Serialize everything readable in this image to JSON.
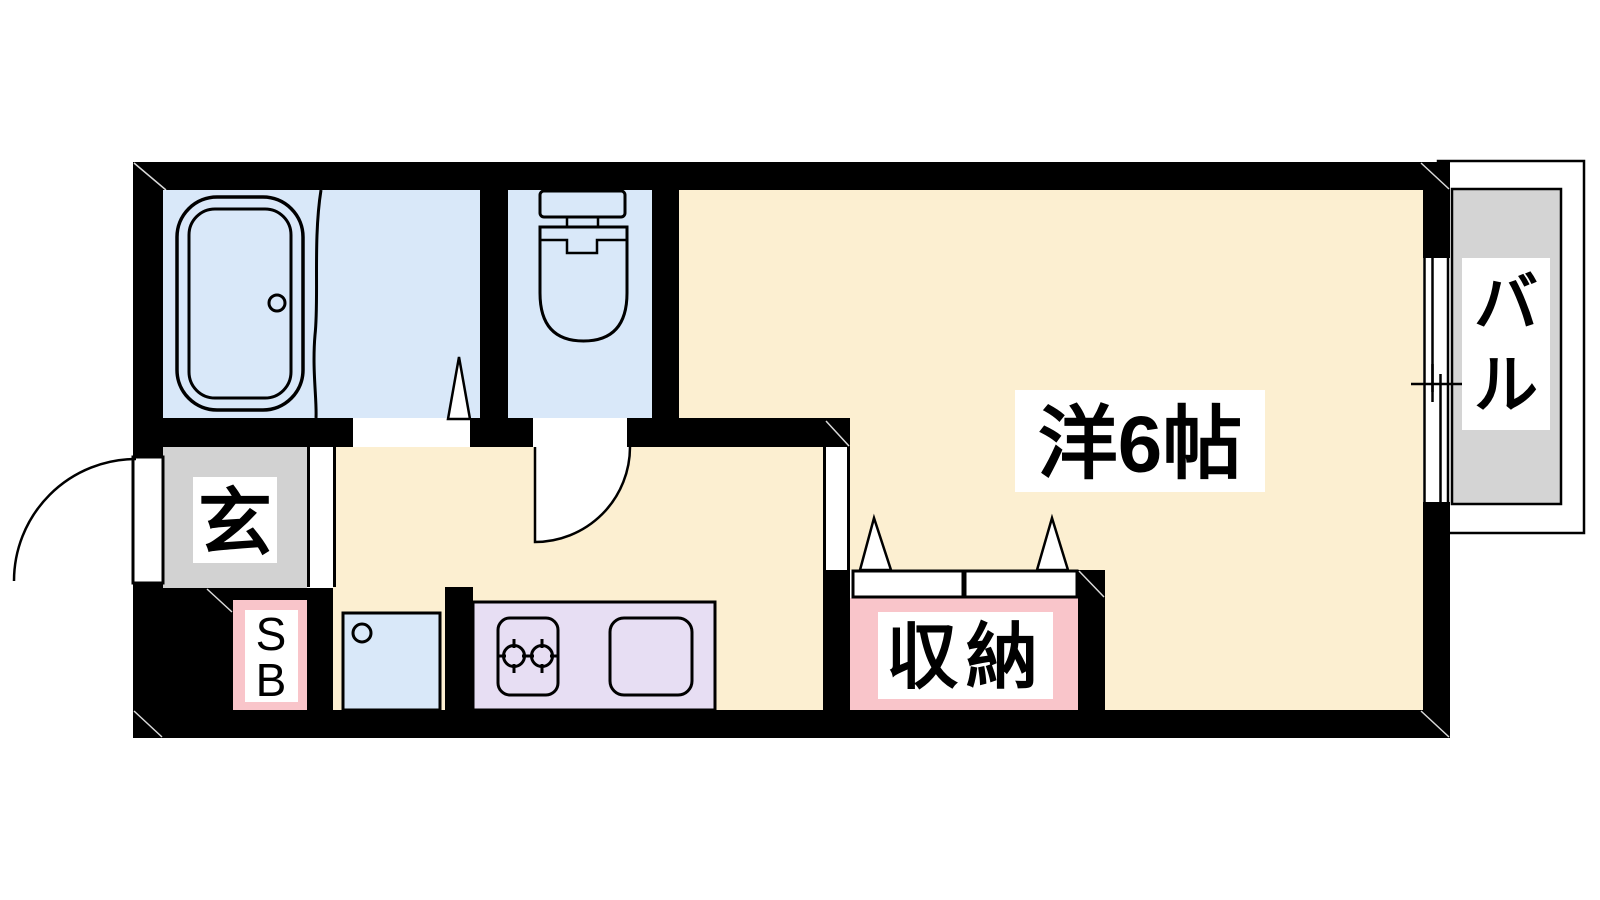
{
  "floorplan": {
    "labels": {
      "entrance": "玄",
      "shoebox_line1": "S",
      "shoebox_line2": "B",
      "storage": "収納",
      "main_room": "洋6帖",
      "balcony_char1": "バ",
      "balcony_char2": "ル"
    },
    "colors": {
      "wall": "#000000",
      "room_floor": "#FCEFD1",
      "wet_area": "#D9E8F9",
      "kitchen": "#E7DEF3",
      "accent_pink": "#F9C5CA",
      "entrance_gray": "#D2D2D2",
      "balcony_gray": "#D4D4D4",
      "line": "#000000",
      "label_bg": "#FFFFFF"
    }
  }
}
